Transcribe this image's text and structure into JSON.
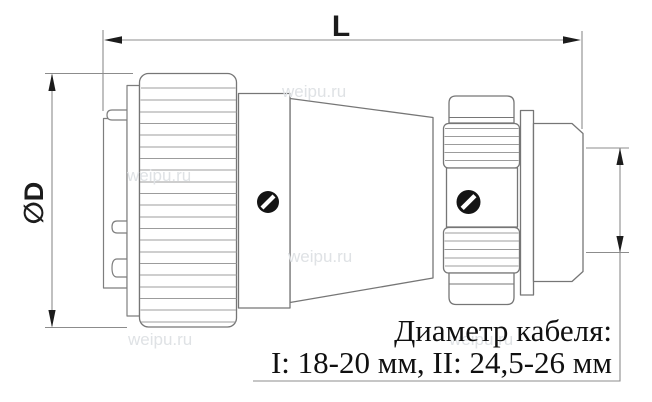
{
  "labels": {
    "length": "L",
    "diameter": "∅D"
  },
  "note": {
    "line1": "Диаметр кабеля:",
    "line2": "I: 18-20 мм, II: 24,5-26 мм"
  },
  "watermark": "weipu.ru",
  "colors": {
    "outline": "#767676",
    "knurl_line": "#9c9c9c",
    "dimension_line": "#8c8c8c",
    "text": "#1c1c1c",
    "screw": "#141414",
    "watermark": "#dfe2e5",
    "background": "#ffffff"
  }
}
